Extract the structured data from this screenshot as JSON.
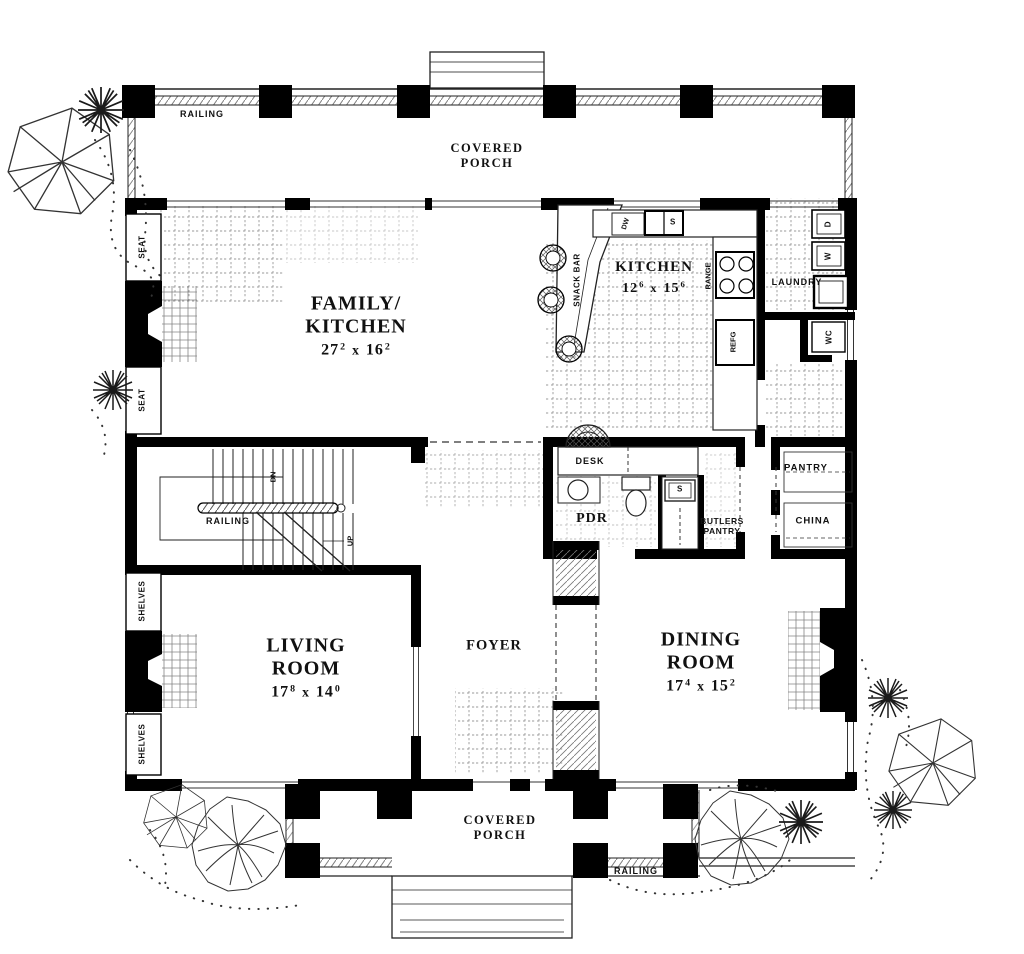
{
  "drawing": {
    "porch_top": {
      "label1": "COVERED",
      "label2": "PORCH",
      "railing": "RAILING"
    },
    "porch_bottom": {
      "label1": "COVERED",
      "label2": "PORCH",
      "railing": "RAILING"
    },
    "family_kitchen": {
      "name1": "FAMILY/",
      "name2": "KITCHEN",
      "dim": {
        "a": "27",
        "asup": "2",
        "times": "x",
        "b": "16",
        "bsup": "2"
      }
    },
    "kitchen": {
      "name": "KITCHEN",
      "dim": {
        "a": "12",
        "asup": "6",
        "times": "x",
        "b": "15",
        "bsup": "6"
      }
    },
    "living_room": {
      "name1": "LIVING",
      "name2": "ROOM",
      "dim": {
        "a": "17",
        "asup": "8",
        "times": "x",
        "b": "14",
        "bsup": "0"
      }
    },
    "dining_room": {
      "name1": "DINING",
      "name2": "ROOM",
      "dim": {
        "a": "17",
        "asup": "4",
        "times": "x",
        "b": "15",
        "bsup": "2"
      }
    },
    "foyer": {
      "name": "FOYER"
    },
    "laundry": {
      "name": "LAUNDRY"
    },
    "pantry": {
      "name": "PANTRY"
    },
    "china": {
      "name": "CHINA"
    },
    "butlers_pantry": {
      "name1": "BUTLERS",
      "name2": "PANTRY"
    },
    "powder_room": {
      "name": "PDR"
    },
    "desk": {
      "name": "DESK"
    },
    "stairs": {
      "railing": "RAILING",
      "down": "DN",
      "up": "UP"
    },
    "fixtures": {
      "snack_bar": "SNACK BAR",
      "dishwasher": "DW",
      "kitchen_sink": "S",
      "range": "RANGE",
      "refrigerator": "REFG",
      "butlers_sink": "S",
      "dryer": "D",
      "washer": "W",
      "water_closet": "WC",
      "seat": "SEAT",
      "shelves": "SHELVES"
    }
  }
}
